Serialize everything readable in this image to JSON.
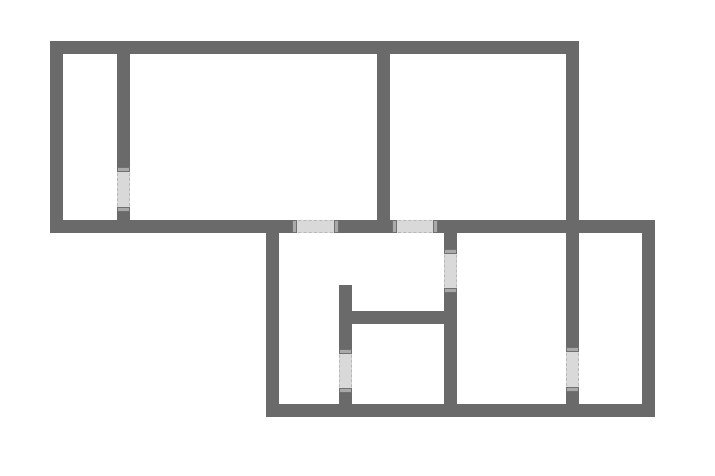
{
  "diagram": {
    "type": "floor-plan",
    "background": "#ffffff",
    "wall_color": "#6a6a6a",
    "door_fill": "#d9d9d9",
    "door_cap_fill": "#a9a9a9",
    "door_cap_border": "#707070",
    "door_dash_color": "#b8b8b8"
  },
  "walls": [
    {
      "name": "outer-top-wall",
      "x": 50,
      "y": 41,
      "w": 529,
      "h": 13
    },
    {
      "name": "outer-left-wall-upper",
      "x": 50,
      "y": 41,
      "w": 13,
      "h": 192
    },
    {
      "name": "middle-horizontal-wall",
      "x": 50,
      "y": 220,
      "w": 605,
      "h": 13
    },
    {
      "name": "right-wall-main",
      "x": 566,
      "y": 41,
      "w": 13,
      "h": 376
    },
    {
      "name": "outer-left-wall-lower",
      "x": 266,
      "y": 220,
      "w": 13,
      "h": 197
    },
    {
      "name": "outer-bottom-wall",
      "x": 266,
      "y": 404,
      "w": 389,
      "h": 13
    },
    {
      "name": "outer-right-wall-lower",
      "x": 642,
      "y": 220,
      "w": 13,
      "h": 197
    },
    {
      "name": "divider-wall-upper-left",
      "x": 117,
      "y": 41,
      "w": 13,
      "h": 192
    },
    {
      "name": "divider-wall-upper-middle",
      "x": 377,
      "y": 41,
      "w": 13,
      "h": 192
    },
    {
      "name": "divider-wall-lower-center",
      "x": 444,
      "y": 220,
      "w": 13,
      "h": 197
    },
    {
      "name": "stub-wall-lower-left",
      "x": 339,
      "y": 285,
      "w": 13,
      "h": 132
    },
    {
      "name": "interior-horizontal-wall",
      "x": 352,
      "y": 311,
      "w": 92,
      "h": 13
    }
  ],
  "doors": [
    {
      "name": "door-upper-left-room",
      "orientation": "vertical",
      "x": 117,
      "y": 168,
      "w": 13,
      "h": 43
    },
    {
      "name": "door-middle-wall-left",
      "orientation": "horizontal",
      "x": 293,
      "y": 220,
      "w": 45,
      "h": 13
    },
    {
      "name": "door-middle-wall-right",
      "orientation": "horizontal",
      "x": 393,
      "y": 220,
      "w": 44,
      "h": 13
    },
    {
      "name": "door-lower-center-upper",
      "orientation": "vertical",
      "x": 444,
      "y": 250,
      "w": 13,
      "h": 42
    },
    {
      "name": "door-lower-center-lower",
      "orientation": "vertical",
      "x": 339,
      "y": 350,
      "w": 13,
      "h": 42
    },
    {
      "name": "door-lower-right-room",
      "orientation": "vertical",
      "x": 566,
      "y": 348,
      "w": 13,
      "h": 43
    }
  ]
}
